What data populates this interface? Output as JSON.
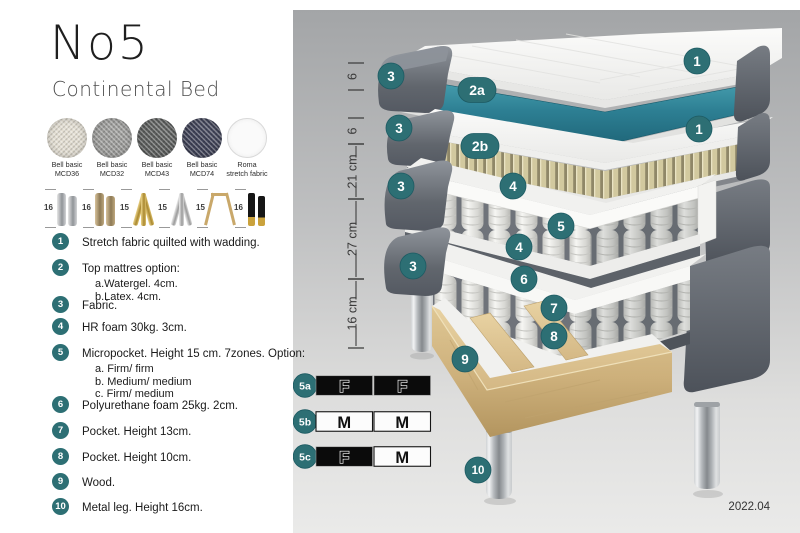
{
  "page": {
    "title": "No5",
    "subtitle": "Continental Bed",
    "version": "2022.04"
  },
  "colors": {
    "accent_teal": "#2d6f74",
    "watergel_teal": "#2d7f93",
    "fabric_gray": "#61666d",
    "latex_beige": "#d2c99f",
    "wood": "#d8bd88",
    "panel_top": "#a3a5a7",
    "panel_bottom": "#eaeae9"
  },
  "swatches": [
    {
      "name": "Bell basic",
      "code": "MCD36",
      "color": "#e3ded2",
      "texture": "woven"
    },
    {
      "name": "Bell basic",
      "code": "MCD32",
      "color": "#9b9b99",
      "texture": "woven"
    },
    {
      "name": "Bell basic",
      "code": "MCD43",
      "color": "#5b5d5c",
      "texture": "woven"
    },
    {
      "name": "Bell basic",
      "code": "MCD74",
      "color": "#3e4156",
      "texture": "woven"
    },
    {
      "name": "Roma",
      "code": "stretch fabric",
      "color": "#fafafa",
      "texture": "plain"
    }
  ],
  "legs": [
    {
      "height": "16",
      "type": "cylinder-silver"
    },
    {
      "height": "16",
      "type": "cylinder-bronze"
    },
    {
      "height": "15",
      "type": "twist-gold"
    },
    {
      "height": "15",
      "type": "twist-silver"
    },
    {
      "height": "15",
      "type": "hairpin-gold"
    },
    {
      "height": "16",
      "type": "straight-black-gold"
    }
  ],
  "parts": [
    {
      "num": "1",
      "text": "Stretch fabric quilted with wadding.",
      "sub": ""
    },
    {
      "num": "2",
      "text": "Top mattres option:",
      "sub": "a.Watergel. 4cm.\nb.Latex. 4cm."
    },
    {
      "num": "3",
      "text": "Fabric.",
      "sub": ""
    },
    {
      "num": "4",
      "text": "HR foam 30kg. 3cm.",
      "sub": ""
    },
    {
      "num": "5",
      "text": "Micropocket. Height 15 cm. 7zones. Option:",
      "sub": "a. Firm/ firm\nb. Medium/ medium\nc. Firm/ medium"
    },
    {
      "num": "6",
      "text": "Polyurethane foam 25kg. 2cm.",
      "sub": ""
    },
    {
      "num": "7",
      "text": "Pocket. Height 13cm.",
      "sub": ""
    },
    {
      "num": "8",
      "text": "Pocket. Height 10cm.",
      "sub": ""
    },
    {
      "num": "9",
      "text": "Wood.",
      "sub": ""
    },
    {
      "num": "10",
      "text": "Metal leg. Height 16cm.",
      "sub": ""
    }
  ],
  "diagram": {
    "measurements": [
      {
        "label": "6",
        "from": 63,
        "to": 90
      },
      {
        "label": "6",
        "from": 118,
        "to": 144
      },
      {
        "label": "21 cm",
        "from": 144,
        "to": 199
      },
      {
        "label": "27 cm",
        "from": 199,
        "to": 279
      },
      {
        "label": "16 cm",
        "from": 279,
        "to": 348
      }
    ],
    "callouts": [
      {
        "label": "1",
        "x": 697,
        "y": 61
      },
      {
        "label": "2a",
        "x": 477,
        "y": 90,
        "pill": true
      },
      {
        "label": "3",
        "x": 391,
        "y": 76
      },
      {
        "label": "1",
        "x": 699,
        "y": 129
      },
      {
        "label": "2b",
        "x": 480,
        "y": 146,
        "pill": true
      },
      {
        "label": "3",
        "x": 399,
        "y": 128
      },
      {
        "label": "3",
        "x": 401,
        "y": 186
      },
      {
        "label": "4",
        "x": 513,
        "y": 186
      },
      {
        "label": "5",
        "x": 561,
        "y": 226
      },
      {
        "label": "4",
        "x": 519,
        "y": 247
      },
      {
        "label": "6",
        "x": 524,
        "y": 279
      },
      {
        "label": "3",
        "x": 413,
        "y": 266
      },
      {
        "label": "7",
        "x": 554,
        "y": 308
      },
      {
        "label": "8",
        "x": 554,
        "y": 336
      },
      {
        "label": "9",
        "x": 465,
        "y": 359
      },
      {
        "label": "10",
        "x": 478,
        "y": 470
      }
    ]
  },
  "firmness_table": {
    "rows": [
      {
        "id": "5a",
        "cells": [
          {
            "letter": "F",
            "style": "dark"
          },
          {
            "letter": "F",
            "style": "dark"
          }
        ]
      },
      {
        "id": "5b",
        "cells": [
          {
            "letter": "M",
            "style": "light"
          },
          {
            "letter": "M",
            "style": "light"
          }
        ]
      },
      {
        "id": "5c",
        "cells": [
          {
            "letter": "F",
            "style": "dark"
          },
          {
            "letter": "M",
            "style": "light"
          }
        ]
      }
    ]
  }
}
